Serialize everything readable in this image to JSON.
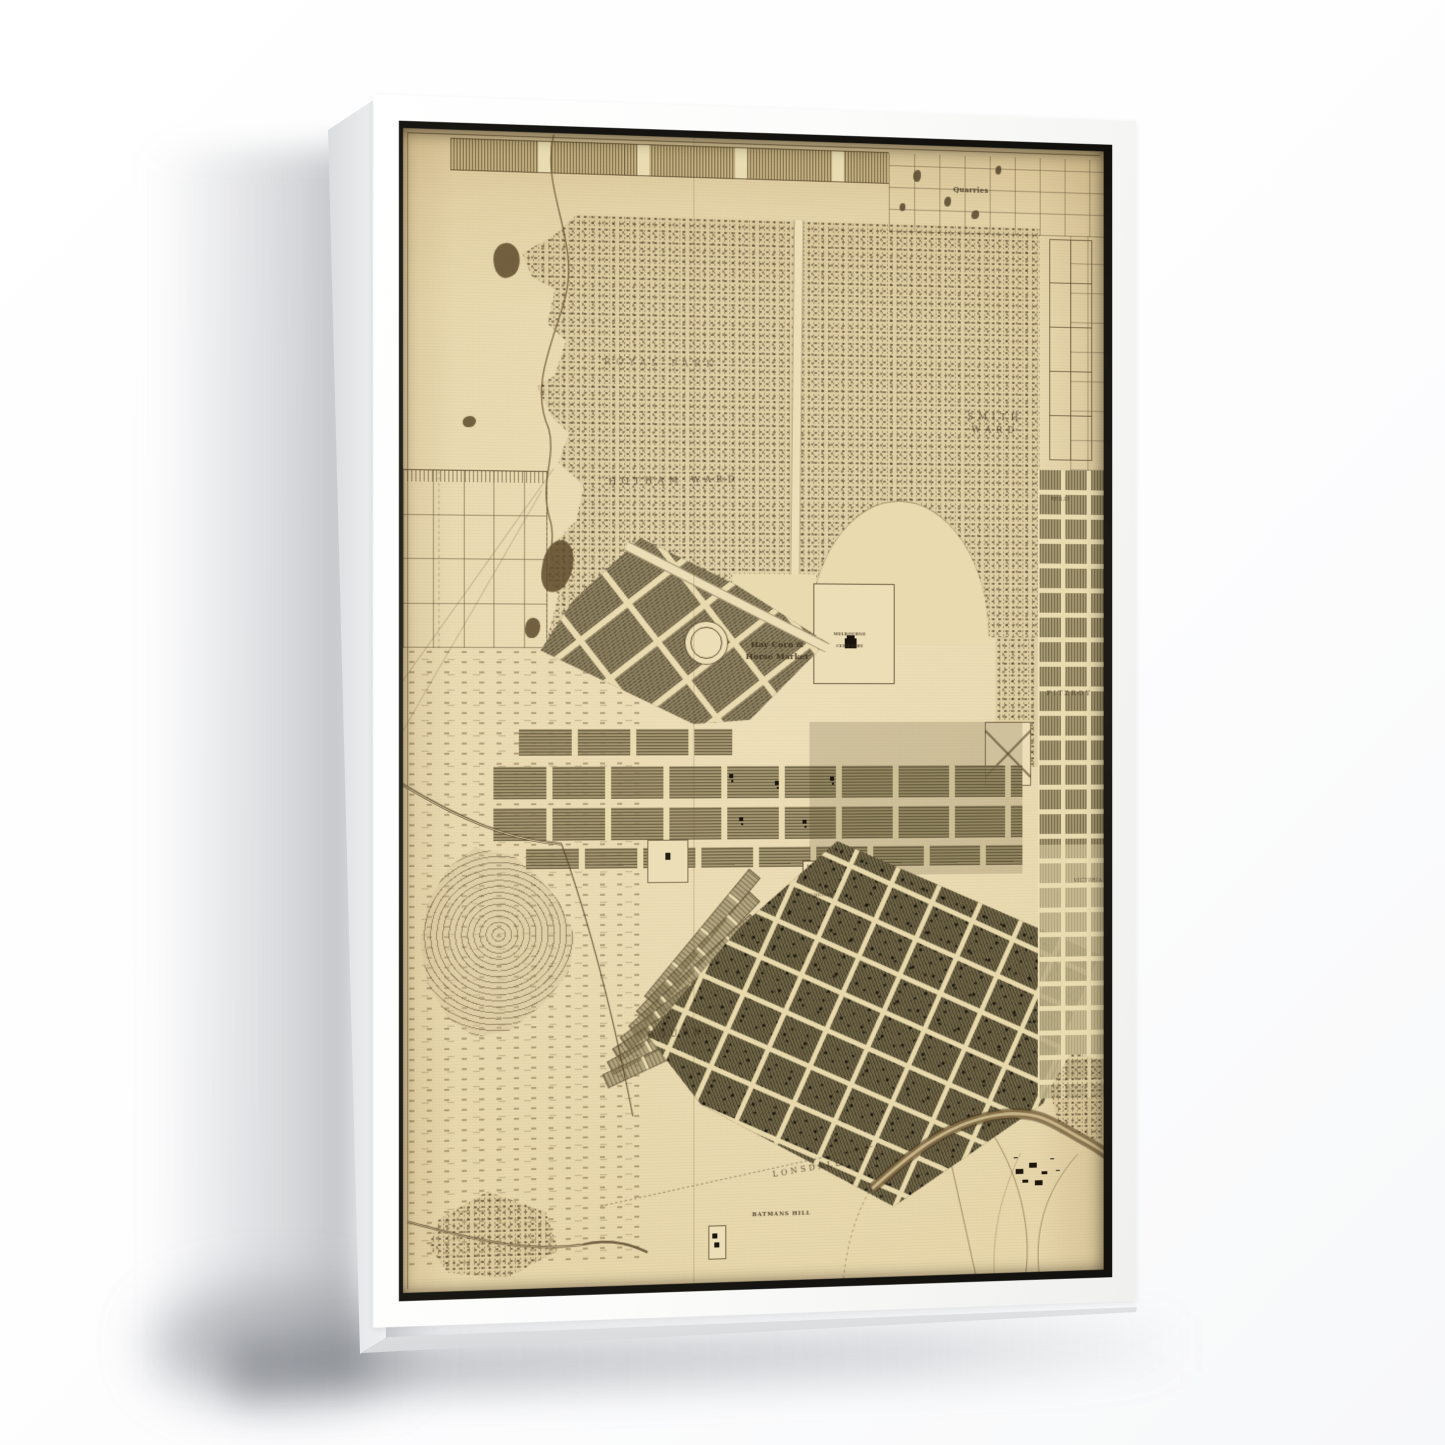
{
  "product": {
    "type": "framed canvas print, floating white frame, product mockup on white background",
    "frame_color": "#fbfbfa",
    "frame_side_color": "#e6e8ea",
    "orientation": "portrait, angled view with left side closer"
  },
  "map": {
    "subject": "antique engraved town plan of Melbourne and suburbs with parkland, swamps and street grids",
    "palette": {
      "paper": "#e7d6aa",
      "paper_light": "#ecdfb8",
      "ink": "#3f3020",
      "stipple_dot": "#3a2d18",
      "block_olive": "#6f6547",
      "block_khaki": "#8d8161",
      "pond_dark": "#5d4a2c",
      "river_brown": "#8a7148",
      "gap_shadow": "#6e6c64"
    },
    "labels": [
      {
        "id": "quarries-label",
        "text": "Quarries",
        "x": 80.4,
        "y": 3.9,
        "size": 7,
        "ls": 0.04,
        "rot": 0,
        "op": 0.9,
        "bold": true
      },
      {
        "id": "royal-park-label",
        "text": "ROYAL PARK",
        "x": 35.9,
        "y": 19.9,
        "size": 9,
        "ls": 0.6,
        "rot": 0,
        "op": 0.5,
        "bold": false
      },
      {
        "id": "hotham-ward-label",
        "text": "HOTHAM WARD",
        "x": 37.8,
        "y": 30.1,
        "size": 9,
        "ls": 0.55,
        "rot": -2,
        "op": 0.75,
        "bold": false
      },
      {
        "id": "smith-ward-label",
        "text": "SMITH WARD",
        "x": 84.0,
        "y": 24.6,
        "size": 9,
        "ls": 0.55,
        "rot": 0,
        "op": 0.75,
        "bold": false
      },
      {
        "id": "haymarket-label",
        "text": "Hay Corn &\nHorse Market",
        "x": 52.4,
        "y": 44.7,
        "size": 8,
        "ls": 0.02,
        "rot": 0,
        "op": 0.95,
        "bold": true
      },
      {
        "id": "melbourne-cemetery-label",
        "text": "MELBOURNE\n\nCEMETERY",
        "x": 62.8,
        "y": 43.8,
        "size": 4,
        "ls": 0.06,
        "rot": 0,
        "op": 0.9,
        "bold": true
      },
      {
        "id": "bourke-ward-label",
        "text": "BOURKE",
        "x": 38.8,
        "y": 78.3,
        "size": 9,
        "ls": 0.5,
        "rot": -3,
        "op": 0.8,
        "bold": false
      },
      {
        "id": "lonsdale-ward-label",
        "text": "LONSDALE",
        "x": 56.8,
        "y": 90.3,
        "size": 8,
        "ls": 0.4,
        "rot": -8,
        "op": 0.8,
        "bold": false
      },
      {
        "id": "batmans-hill-label",
        "text": "BATMANS HILL",
        "x": 53.0,
        "y": 94.2,
        "size": 5.5,
        "ls": 0.15,
        "rot": 0,
        "op": 0.9,
        "bold": true
      },
      {
        "id": "fitzroy-label",
        "text": "FITZROY",
        "x": 94.9,
        "y": 48.5,
        "size": 7,
        "ls": 0.3,
        "rot": 0,
        "op": 0.8,
        "bold": false
      },
      {
        "id": "reilly-street-label",
        "text": "REILLY",
        "x": 93.6,
        "y": 31.3,
        "size": 4.5,
        "ls": 0.12,
        "rot": 0,
        "op": 0.8,
        "bold": false
      },
      {
        "id": "old-cemetery-label",
        "text": "CEMETERY",
        "x": 58.6,
        "y": 66.3,
        "size": 4,
        "ls": 0.1,
        "rot": 0,
        "op": 0.85,
        "bold": false
      },
      {
        "id": "victoria-parade-label",
        "text": "VICTORIA",
        "x": 97.7,
        "y": 65.3,
        "size": 4.5,
        "ls": 0.18,
        "rot": 0,
        "op": 0.8,
        "bold": false
      }
    ]
  }
}
